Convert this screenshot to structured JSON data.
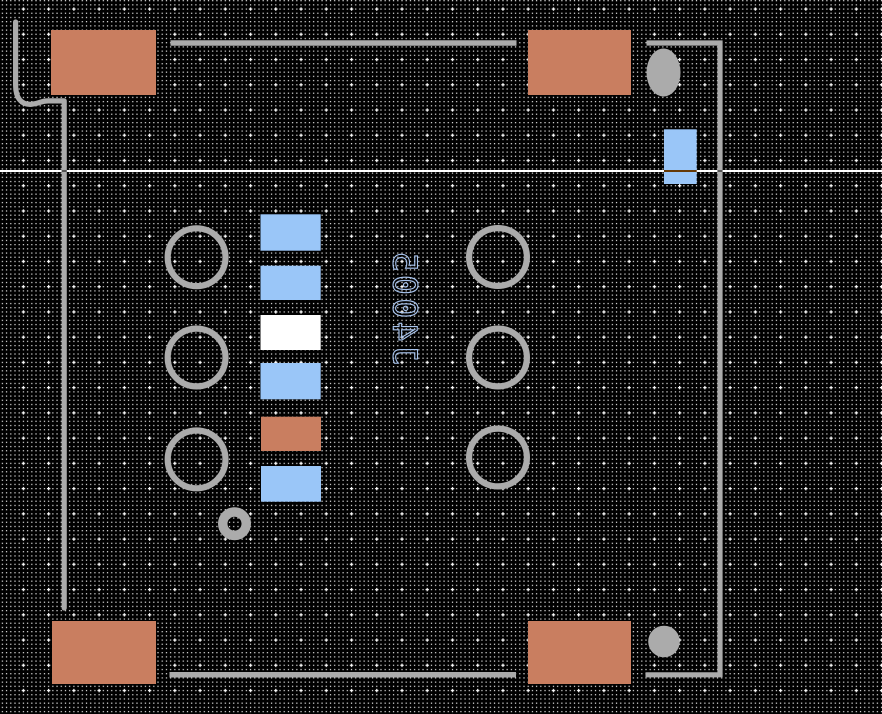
{
  "refdes": {
    "text": "J4005"
  },
  "colors": {
    "background": "#000000",
    "grid_dot": "#e8e8e8",
    "grid_cross": "#ffffff",
    "silkscreen": "#ababab",
    "hole_ring": "#ababab",
    "pad_top": "#c97e60",
    "pad_bottom": "#9ac6f8",
    "pad_highlight": "#ffffff",
    "refdes_color": "#a8c4ee",
    "crosshair": "#ffffff"
  }
}
